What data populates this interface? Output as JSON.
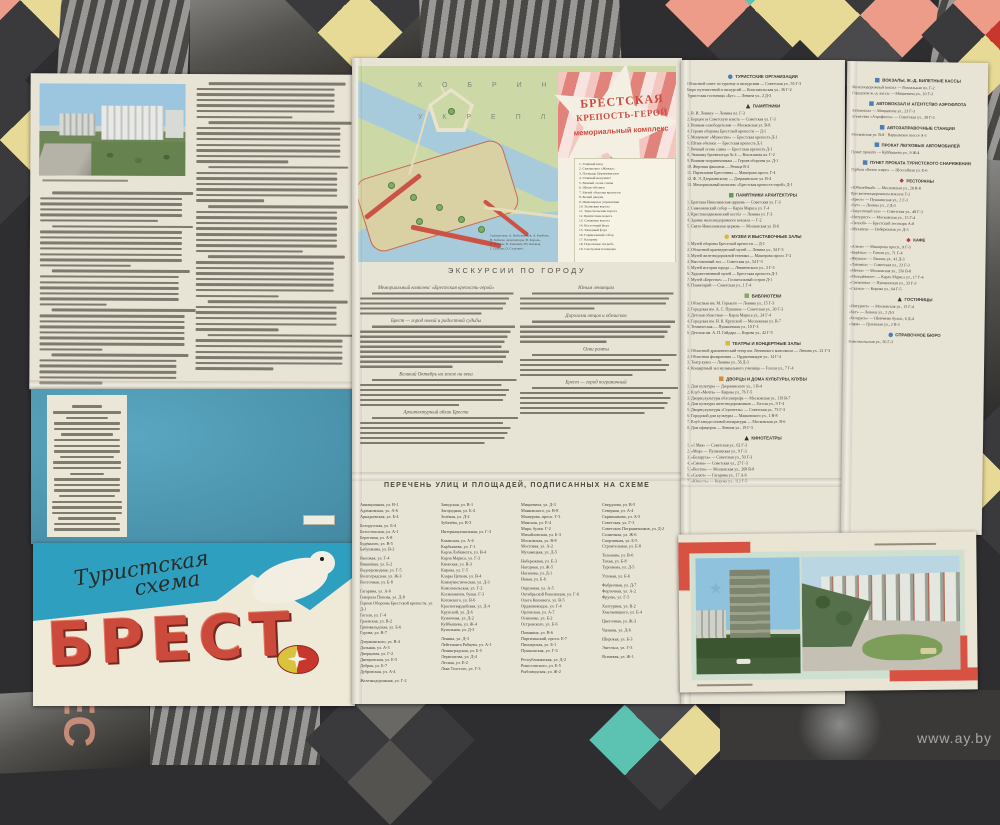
{
  "watermark": "www.ay.by",
  "colors": {
    "paper": "#e7e3d5",
    "cover_blue": "#2f9fc0",
    "back_cover_blue": "#4f9ab4",
    "title_red": "#cb4a3b",
    "map_land": "#ccd8a6",
    "map_water": "#a7cbdb",
    "rampart_red": "#cc5344",
    "corner_red": "#d85243",
    "bg_dark": "#2e2d30",
    "bg_salmon": "#ec9c88",
    "bg_teal": "#5cc2b2",
    "bg_yellow": "#e7da96"
  },
  "cover": {
    "script_line1": "Туристская",
    "script_line2": "схема",
    "title": "БРЕСТ"
  },
  "left_text": {
    "col_right_pars": [
      7,
      8,
      7,
      9,
      8,
      6,
      7
    ],
    "col_left_pars": [
      6,
      8,
      7,
      8,
      6
    ],
    "photo_caption_lines": [
      1
    ]
  },
  "back_cover": {
    "imprint_pars": [
      3,
      4,
      4,
      3,
      4,
      3,
      2
    ]
  },
  "fortress_map": {
    "area_label_line1": "К О Б Р И Н С К О Е",
    "area_label_line2": "У К Р Е П Л Е Н И Е",
    "title_line1": "БРЕСТСКАЯ",
    "title_line2": "КРЕПОСТЬ-ГЕРОЙ",
    "subtitle": "мемориальный комплекс",
    "legend": [
      "1. Главный вход",
      "2. Скульптура «Жажда»",
      "3. Площадь Церемониалов",
      "4. Главный монумент",
      "5. Вечный огонь славы",
      "6. Штык-обелиск",
      "7. Музей обороны крепости",
      "8. Белый дворец",
      "9. Инженерное управление",
      "10. Холмские ворота",
      "11. Тереспольские ворота",
      "12. Бригитские ворота",
      "13. Северные ворота",
      "14. Восточный форт",
      "15. Западный форт",
      "16. Гарнизонный собор",
      "17. Казармы",
      "18. Пороховые погреба",
      "19. Смотровая площадка"
    ],
    "note": [
      "Скульпторы: А. Кибальников, А. Бембель,",
      "В. Бобыль; архитекторы: В. Король,",
      "В. Волчек, В. Занкович, Ю. Казаков,",
      "Г. Сысоев, О. Стахович"
    ]
  },
  "excursions": {
    "heading": "ЭКСКУРСИИ ПО ГОРОДУ",
    "col1": [
      {
        "h": "Мемориальный комплекс «Брестская крепость-герой»",
        "n": 5
      },
      {
        "h": "Брест — город новой и радостной судьбы",
        "n": 9
      },
      {
        "h": "Великий Октябрь на земле на века",
        "n": 6
      },
      {
        "h": "Архитектурный облик Бреста",
        "n": 6
      }
    ],
    "col2": [
      {
        "h": "Юным ленинцам",
        "n": 4
      },
      {
        "h": "Дорогами отцов и обелисков",
        "n": 5
      },
      {
        "h": "Огни рампы",
        "n": 5
      },
      {
        "h": "Брест — город пограничный",
        "n": 6
      }
    ]
  },
  "street_index": {
    "heading": "ПЕРЕЧЕНЬ УЛИЦ И ПЛОЩАДЕЙ, ПОДПИСАННЫХ НА СХЕМЕ",
    "columns": [
      [
        "Авиационная, ул. В-1",
        "Адамковская, ул. А-6",
        "Аркадьевская, ул. Б-4",
        "Белорусская, ул. Б-4",
        "Белостокская, ул. А-1",
        "Береговая, ул. А-8",
        "Будённого, ул. В-5",
        "Бабушкина, ул. В-3",
        "Высокая, ул. Г-4",
        "Вишнёвая, ул. Б-2",
        "Водопроводная, ул. Г-5",
        "Волгоградская, ул. Ж-3",
        "Восточная, ул. Б-8",
        "Гагарина, ул. А-6",
        "Генерала Попова, ул. Д-8",
        "Героев Обороны Брестской крепости, ул. Д-1",
        "Гоголя, ул. Г-4",
        "Граевская, ул. В-2",
        "Грюнвальдская, ул. Б-6",
        "Гурова, ул. В-7",
        "Дзержинского, ул. В-4",
        "Дальняя, ул. А-3",
        "Дворцовая, ул. Г-2",
        "Днепровская, ул. Е-5",
        "Добрая, ул. Б-7",
        "Дубровская, ул. А-4",
        "Железнодорожная, ул. Г-2"
      ],
      [
        "Заводская, ул. В-1",
        "Загородная, ул. Б-4",
        "Зелёная, ул. Д-2",
        "Зубачёва, ул. В-3",
        "Интернациональная, ул. Г-3",
        "Казанская, ул. А-6",
        "Карбышева, ул. Г-1",
        "Карла Либкнехта, ул. В-4",
        "Карла Маркса, ул. Г-3",
        "Киевская, ул. В-3",
        "Кирова, ул. Г-5",
        "Клары Цеткин, ул. В-4",
        "Коммунистическая, ул. Д-3",
        "Комсомольская, ул. Г-2",
        "Космонавтов, бульв. Г-3",
        "Котовского, ул. В-6",
        "Красногвардейская, ул. Д-4",
        "Крупской, ул. Д-6",
        "Кузнечная, ул. Д-2",
        "Куйбышева, ул. Ж-4",
        "Купальная, ул. Д-3",
        "Ленина, ул. Д-3",
        "Лейтенанта Рябцева, ул. А-1",
        "Ленинградская, ул. Б-5",
        "Лермонтова, ул. Д-4",
        "Лесная, ул. Е-2",
        "Льва Толстого, ул. Г-3"
      ],
      [
        "Мицкевича, ул. Д-3",
        "Маяковского, ул. В-8",
        "Машерова, просп. Г-3",
        "Минская, ул. Е-4",
        "Мира, бульв. Г-2",
        "Михайловская, ул. Б-3",
        "Московская, ул. В-8",
        "Мостовая, ул. А-2",
        "Мухавецкая, ул. Д-5",
        "Набережная, ул. Е-3",
        "Нагорная, ул. Ж-5",
        "Наганова, ул. Д-1",
        "Новая, ул. Б-6",
        "Окружная, ул. А-5",
        "Октябрьской Революции, ул. Г-6",
        "Олега Кошевого, ул. В-5",
        "Орджоникидзе, ул. Г-4",
        "Орловская, ул. А-7",
        "Осипенко, ул. Б-2",
        "Островского, ул. Е-6",
        "Папанина, ул. В-6",
        "Партизанский, просп. Е-7",
        "Пионерская, ул. Б-1",
        "Пушкинская, ул. Г-3",
        "Республиканская, ул. Д-2",
        "Рокоссовского, ул. Е-5",
        "Рыбзаводская, ул. Ж-2"
      ],
      [
        "Свердлова, ул. В-5",
        "Северная, ул. А-4",
        "Скрипникова, ул. А-5",
        "Советская, ул. Г-3",
        "Советских Пограничников, ул. Д-2",
        "Солнечная, ул. Ж-6",
        "Спортивная, ул. Б-5",
        "Строительная, ул. Е-8",
        "Тельмана, ул. В-6",
        "Тихая, ул. Б-8",
        "Тургенева, ул. Д-5",
        "Угловая, ул. Б-6",
        "Фабричная, ул. Д-7",
        "Фортечная, ул. А-2",
        "Фрунзе, ул. Г-5",
        "Халтурина, ул. В-2",
        "Хмельницкого, ул. Е-4",
        "Цветочная, ул. Ж-3",
        "Чапаева, ул. Д-6",
        "Широкая, ул. Б-3",
        "Энгельса, ул. Г-3",
        "Ясеневая, ул. Ж-1"
      ]
    ]
  },
  "directory_col1": [
    {
      "ic": [
        "ci",
        "#4a7fb5"
      ],
      "t": "ТУРИСТСКИЕ ОРГАНИЗАЦИИ",
      "items": [
        "Областной совет по туризму и экскурсиям — Советская ул., 53 Г-3",
        "Бюро путешествий и экскурсий — Комсомольская ул., 36 Г-2",
        "Туристская гостиница «Буг» — Ленина ул., 2 Д-3"
      ]
    },
    {
      "ic": [
        "tr",
        "#3a3a34"
      ],
      "t": "ПАМЯТНИКИ",
      "items": [
        "1. В. И. Ленину — Ленина пл. Г-3",
        "2. Борцам за Советскую власть — Советская ул. Г-3",
        "3. Воинам-освободителям — Московская ул. В-8",
        "4. Героям обороны Брестской крепости — Д-1",
        "5. Монумент «Мужество» — Брестская крепость Д-1",
        "6. Штык-обелиск — Брестская крепость Д-1",
        "7. Вечный огонь славы — Брестская крепость Д-1",
        "8. Экипажу бронепоезда № 4 — Вокзальная пл. Г-2",
        "9. Воинам-пограничникам — Героев обороны ул. Д-1",
        "10. Жертвам фашизма — Речица В-2",
        "11. Партизанам Брестчины — Машерова просп. Г-4",
        "12. Ф. Э. Дзержинскому — Дзержинского ул. В-4",
        "13. Мемориальный комплекс «Брестская крепость-герой» Д-1"
      ]
    },
    {
      "ic": [
        "sq",
        "#5f9e57"
      ],
      "t": "ПАМЯТНИКИ АРХИТЕКТУРЫ",
      "items": [
        "1. Братская Николаевская церковь — Советская ул. Г-3",
        "2. Симеоновский собор — Карла Маркса ул. Г-4",
        "3. Крестовоздвиженский костёл — Ленина ул. Г-3",
        "4. Здание железнодорожного вокзала — Г-2",
        "5. Свято-Николаевская церковь — Московская ул. В-6"
      ]
    },
    {
      "ic": [
        "ci",
        "#d8b83c"
      ],
      "t": "МУЗЕИ И ВЫСТАВОЧНЫЕ ЗАЛЫ",
      "items": [
        "1. Музей обороны Брестской крепости — Д-1",
        "2. Областной краеведческий музей — Ленина ул., 34 Г-3",
        "3. Музей железнодорожной техники — Машерова просп. Г-2",
        "4. Выставочный зал — Советская ул., 54 Г-3",
        "5. Музей истории города — Леваневского ул., 3 Г-3",
        "6. Художественный музей — Брестская крепость Д-1",
        "7. Музей «Берестье» — Госпитальный остров Д-1",
        "8. Планетарий — Советская ул., 1 Г-4"
      ]
    },
    {
      "ic": [
        "sq",
        "#7fae62"
      ],
      "t": "БИБЛИОТЕКИ",
      "items": [
        "1. Областная им. М. Горького — Ленина ул., 15 Г-3",
        "2. Городская им. А. С. Пушкина — Советская ул., 30 Г-3",
        "3. Детская областная — Карла Маркса ул., 24 Г-4",
        "4. Городская им. Н. К. Крупской — Московская ул. В-7",
        "5. Техническая — Пушкинская ул., 10 Г-3",
        "6. Детская им. А. П. Гайдара — Кирова ул., 42 Г-5"
      ]
    },
    {
      "ic": [
        "sq",
        "#d8b83c"
      ],
      "t": "ТЕАТРЫ И КОНЦЕРТНЫЕ ЗАЛЫ",
      "items": [
        "1. Областной драматический театр им. Ленинского комсомола — Ленина ул., 21 Г-3",
        "2. Областная филармония — Орджоникидзе ул., 14 Г-4",
        "3. Театр кукол — Ленина ул., 56 Д-3",
        "4. Концертный зал музыкального училища — Гоголя ул., 7 Г-4"
      ]
    },
    {
      "ic": [
        "sq",
        "#d88a3c"
      ],
      "t": "ДВОРЦЫ И ДОМА КУЛЬТУРЫ, КЛУБЫ",
      "items": [
        "1. Дом культуры — Дзержинского ул., 1 В-4",
        "2. Клуб «Мечта» — Кирова ул., 76 Г-5",
        "3. Дворец культуры облсовпрофа — Московская ул., 119 В-7",
        "4. Дом культуры железнодорожников — Гоголя ул., 9 Г-4",
        "5. Дворец культуры «Строитель» — Советская ул., 73 Г-3",
        "6. Городской дом культуры — Маяковского ул., 1 В-8",
        "7. Клуб завода газовой аппаратуры — Московская ул. В-6",
        "8. Дом офицеров — Ленина ул., 19 Г-3"
      ]
    },
    {
      "ic": [
        "tr",
        "#2e2e2a"
      ],
      "t": "КИНОТЕАТРЫ",
      "items": [
        "1. «1 Мая» — Советская ул., 62 Г-3",
        "2. «Мир» — Пушкинская ул., 9 Г-3",
        "3. «Беларусь» — Советская ул., 50 Г-3",
        "4. «Смена» — Советская ул., 27 Г-3",
        "5. «Восток» — Московская ул., 268 В-8",
        "6. «Салют» — Гагарина ул., 17 А-6",
        "7. «Юность» — Кирова ул., 112 Г-5"
      ]
    }
  ],
  "directory_col2": [
    {
      "ic": [
        "sq",
        "#4a7fb5"
      ],
      "t": "ВОКЗАЛЫ, Ж.-Д. БИЛЕТНЫЕ КАССЫ",
      "items": [
        "Железнодорожный вокзал — Вокзальная пл. Г-2",
        "Городские ж.-д. кассы — Мицкевича ул., 10 Г-3"
      ]
    },
    {
      "ic": [
        "sq",
        "#4a7fb5"
      ],
      "t": "АВТОВОКЗАЛ И АГЕНТСТВО АЭРОФЛОТА",
      "items": [
        "Автовокзал — Мицкевича ул., 23 Г-3",
        "Агентство «Аэрофлота» — Советская ул., 38 Г-3"
      ]
    },
    {
      "ic": [
        "sq",
        "#4a7fb5"
      ],
      "t": "АВТОЗАПРАВОЧНЫЕ СТАНЦИИ",
      "items": [
        "Московская ул. В-8  ·  Варшавское шоссе А-1"
      ]
    },
    {
      "ic": [
        "sq",
        "#4a7fb5"
      ],
      "t": "ПРОКАТ ЛЕГКОВЫХ АВТОМОБИЛЕЙ",
      "items": [
        "Пункт проката — Куйбышева ул., 9 Ж-4"
      ]
    },
    {
      "ic": [
        "sq",
        "#4a7fb5"
      ],
      "t": "ПУНКТ ПРОКАТА ТУРИСТСКОГО СНАРЯЖЕНИЯ",
      "items": [
        "Турбаза «Белое озеро» — Шоссейная ул. Е-6"
      ]
    },
    {
      "ic": [
        "dm",
        "#b53c3c"
      ],
      "t": "РЕСТОРАНЫ",
      "items": [
        "«Юбилейный» — Московская ул., 28 В-8",
        "При железнодорожном вокзале Г-2",
        "«Брест» — Пушкинская ул., 2 Г-3",
        "«Буг» — Ленина ул., 2 Д-3",
        "«Закусочный зал» — Советская ул., 48 Г-3",
        "«Интурист» — Московская ул., 15 Г-4",
        "«Лесной» — Брестский лесопарк А-8",
        "«Мухавец» — Набережная ул. Д-3"
      ]
    },
    {
      "ic": [
        "dm",
        "#b53c3c"
      ],
      "t": "КАФЕ",
      "items": [
        "«Алеся» — Машерова просп., 9 Г-3",
        "«Берёзка» — Гоголя ул., 71 Г-4",
        "«Ивушка» — Ленина ул., 41 Д-3",
        "«Лакомка» — Советская ул., 23 Г-3",
        "«Мечта» — Московская ул., 250 В-8",
        "«Молодёжное» — Карла Маркса ул., 17 Г-4",
        "«Снежинка» — Пушкинская ул., 33 Г-3",
        "«Сказка» — Кирова ул., 64 Г-5"
      ]
    },
    {
      "ic": [
        "tr",
        "#3a3a34"
      ],
      "t": "ГОСТИНИЦЫ",
      "items": [
        "«Интурист» — Московская ул., 15 Г-4",
        "«Буг» — Ленина ул., 2 Д-3",
        "«Беларусь» — Шевченко бульв., 6 Д-4",
        "«Заря» — Граевская ул., 2 В-2"
      ]
    },
    {
      "ic": [
        "ci",
        "#4a7fb5"
      ],
      "t": "СПРАВОЧНОЕ БЮРО",
      "items": [
        "Комсомольская ул., 50 Г-3"
      ]
    }
  ]
}
